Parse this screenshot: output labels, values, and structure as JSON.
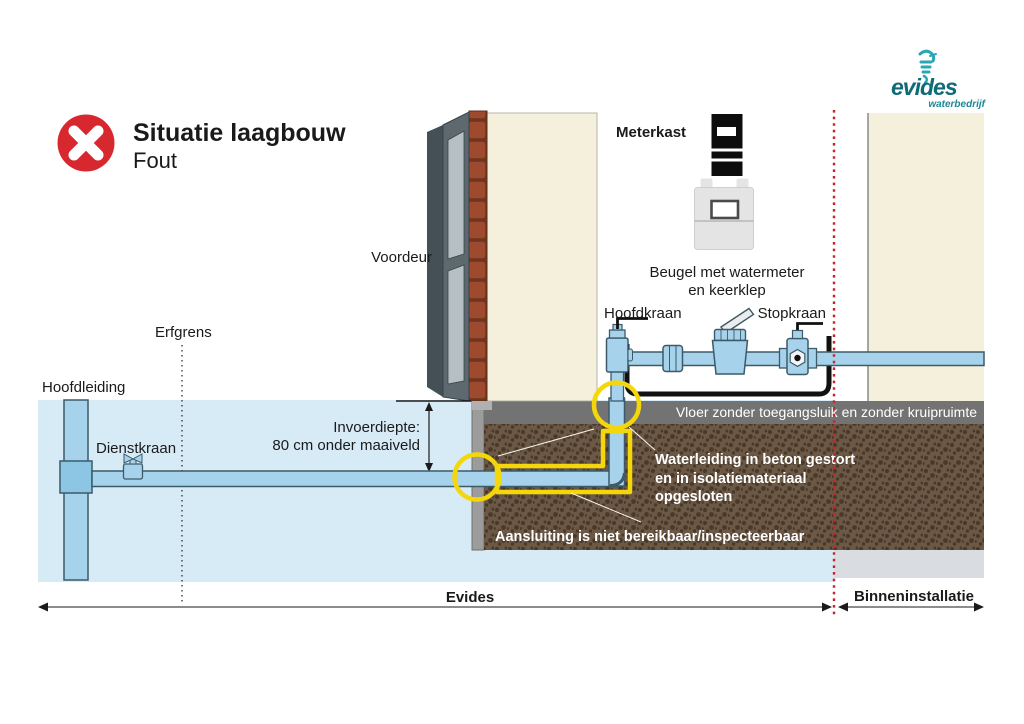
{
  "header": {
    "title": "Situatie laagbouw",
    "subtitle": "Fout",
    "status_icon": "error-cross"
  },
  "logo": {
    "brand": "evides",
    "tagline": "waterbedrijf"
  },
  "labels": {
    "meterkast": "Meterkast",
    "voordeur": "Voordeur",
    "erfgrens": "Erfgrens",
    "hoofdleiding": "Hoofdleiding",
    "dienstkraan": "Dienstkraan",
    "hoofdkraan": "Hoofdkraan",
    "stopkraan": "Stopkraan",
    "beugel_line1": "Beugel met watermeter",
    "beugel_line2": "en keerklep",
    "invoerdiepte_line1": "Invoerdiepte:",
    "invoerdiepte_line2": "80 cm onder maaiveld",
    "vloer": "Vloer zonder toegangsluik en zonder kruipruimte",
    "waterleiding_line1": "Waterleiding in beton gestort",
    "waterleiding_line2": "en in isolatiemateriaal",
    "waterleiding_line3": "opgesloten",
    "aansluiting": "Aansluiting is niet bereikbaar/inspecteerbaar",
    "zone_left": "Evides",
    "zone_right": "Binneninstallatie"
  },
  "colors": {
    "error_red": "#d7282f",
    "pipe_blue": "#a6d3eb",
    "highlight_yellow": "#f4d70a",
    "boundary_red": "#c1272d",
    "ground_blue": "#d7ebf7",
    "wall_cream": "#f5f0dc",
    "soil_brown": "#6b5946",
    "brand_teal": "#0e6b77"
  }
}
